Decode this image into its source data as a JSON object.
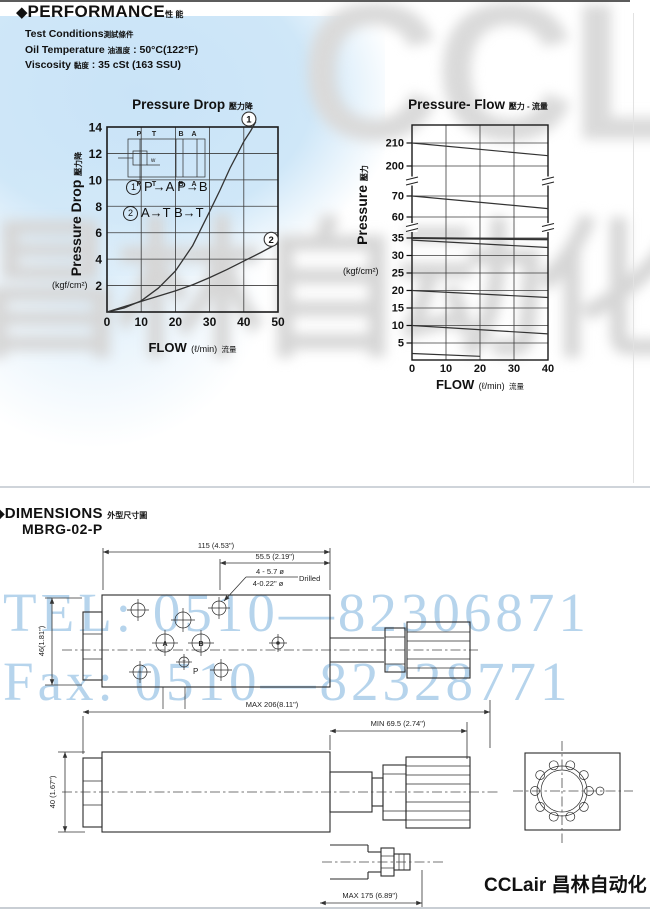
{
  "performance": {
    "bullet": "◆",
    "title": "PERFORMANCE",
    "title_cn": "性 能",
    "conditions": [
      {
        "en": "Test Conditions",
        "cn": "測試條件",
        "value": ""
      },
      {
        "en": "Oil Temperature",
        "cn": "油溫度",
        "value": ": 50°C(122°F)"
      },
      {
        "en": "Viscosity",
        "cn": "黏度",
        "value": ": 35 cSt (163 SSU)"
      }
    ]
  },
  "chart_data": [
    {
      "type": "line",
      "title": "Pressure Drop",
      "title_cn": "壓力降",
      "xlabel": "FLOW",
      "x_unit": "(ℓ/min)",
      "x_unit_cn": "流量",
      "ylabel": "Pressure Drop",
      "ylabel_cn": "壓力降",
      "y_unit": "(kgf/cm²)",
      "xlim": [
        0,
        50
      ],
      "ylim": [
        0,
        14
      ],
      "xticks": [
        0,
        10,
        20,
        30,
        40,
        50
      ],
      "yticks": [
        2,
        4,
        6,
        8,
        10,
        12,
        14
      ],
      "grid": true,
      "legend": [
        {
          "n": "1",
          "text": "P→A  P→B"
        },
        {
          "n": "2",
          "text": "A→T  B→T"
        }
      ],
      "inset_ports": [
        "P",
        "T",
        "B",
        "A"
      ],
      "inset_spring": "w",
      "series": [
        {
          "name": "curve-1 P→A P→B",
          "points": [
            [
              0,
              0
            ],
            [
              5,
              0.3
            ],
            [
              10,
              0.85
            ],
            [
              15,
              1.8
            ],
            [
              20,
              3.1
            ],
            [
              25,
              5.0
            ],
            [
              30,
              7.6
            ],
            [
              33,
              9.2
            ],
            [
              36,
              10.9
            ],
            [
              38,
              11.9
            ],
            [
              40,
              12.9
            ],
            [
              42,
              13.7
            ],
            [
              43.5,
              14.4
            ]
          ]
        },
        {
          "name": "curve-2 A→T B→T",
          "points": [
            [
              0,
              0
            ],
            [
              10,
              0.8
            ],
            [
              20,
              1.6
            ],
            [
              25,
              2.05
            ],
            [
              30,
              2.6
            ],
            [
              35,
              3.2
            ],
            [
              40,
              3.85
            ],
            [
              45,
              4.5
            ],
            [
              50,
              5.2
            ]
          ]
        }
      ],
      "curve_labels": [
        {
          "n": "1",
          "at": [
            41.5,
            14.6
          ]
        },
        {
          "n": "2",
          "at": [
            48,
            5.5
          ]
        }
      ]
    },
    {
      "type": "line",
      "title": "Pressure- Flow",
      "title_cn": "壓力 - 流量",
      "xlabel": "FLOW",
      "x_unit": "(ℓ/min)",
      "x_unit_cn": "流量",
      "ylabel": "Pressure",
      "ylabel_cn": "壓力",
      "y_unit": "(kgf/cm²)",
      "xlim": [
        0,
        40
      ],
      "xticks": [
        0,
        10,
        20,
        30,
        40
      ],
      "yticks": [
        5,
        10,
        15,
        20,
        25,
        30,
        35,
        60,
        70,
        200,
        210
      ],
      "y_axis_breaks": [
        [
          35,
          60
        ],
        [
          70,
          200
        ]
      ],
      "grid": true,
      "series": [
        {
          "name": "setting 210",
          "points": [
            [
              0,
              210
            ],
            [
              40,
              204.5
            ]
          ]
        },
        {
          "name": "setting 70",
          "points": [
            [
              0,
              70
            ],
            [
              40,
              64
            ]
          ]
        },
        {
          "name": "setting 35 upper",
          "points": [
            [
              0,
              35
            ],
            [
              40,
              34.6
            ]
          ],
          "width": 2
        },
        {
          "name": "setting 35 lower",
          "points": [
            [
              0,
              34.4
            ],
            [
              40,
              32.3
            ]
          ]
        },
        {
          "name": "setting 20",
          "points": [
            [
              0,
              20
            ],
            [
              40,
              18
            ]
          ]
        },
        {
          "name": "setting 10",
          "points": [
            [
              0,
              10
            ],
            [
              40,
              7.6
            ]
          ]
        },
        {
          "name": "setting min",
          "points": [
            [
              0,
              2
            ],
            [
              20,
              1.2
            ]
          ]
        }
      ]
    }
  ],
  "dimensions": {
    "bullet": "◆",
    "title": "DIMENSIONS",
    "title_cn": "外型尺寸圖",
    "model": "MBRG-02-P",
    "labels": {
      "width_overall": "115 (4.53\")",
      "width_right": "55.5 (2.19\")",
      "drill_top": "4 - 5.7 ø",
      "drill_bottom": "4-0.22\" ø",
      "drill_note": "Drilled",
      "height_top_view": "46(1.81\")",
      "max_length": "MAX  206(8.11\")",
      "min_knob": "MIN  69.5 (2.74\")",
      "height_side_view": "40 (1.67\")",
      "max_length_alt": "MAX 175 (6.89\")"
    },
    "ports": {
      "a": "A",
      "b": "B",
      "t": "T",
      "p": "P"
    }
  },
  "watermarks": {
    "tel": "TEL: 0510—82306871",
    "fax": "Fax: 0510—82328771",
    "gray_right": "CCLair",
    "gray_left": "昌林自动化"
  },
  "footer": {
    "brand": "CCLair 昌林自动化"
  }
}
